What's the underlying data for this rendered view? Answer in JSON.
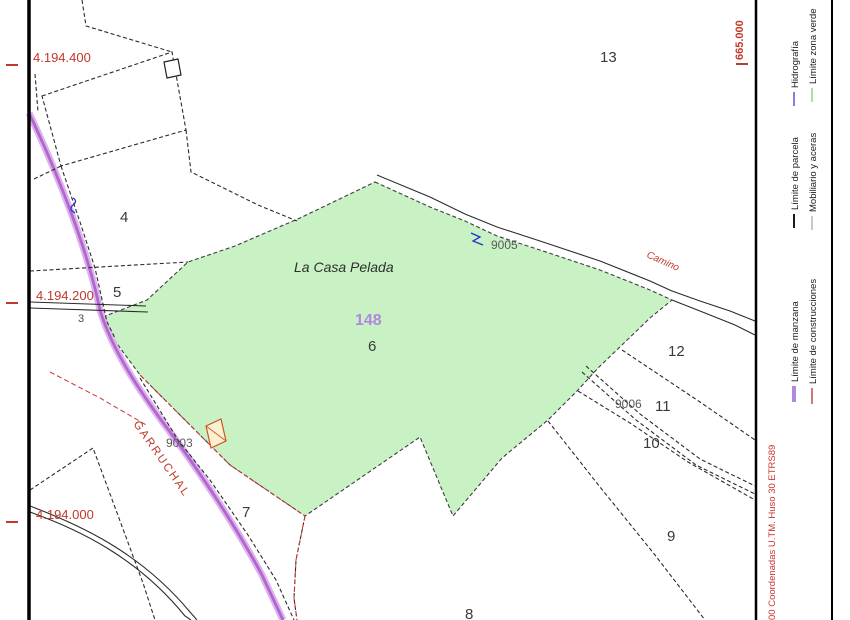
{
  "area": {
    "name": "La Casa Pelada",
    "block": "148"
  },
  "parcels": [
    "4",
    "13",
    "5",
    "3",
    "12",
    "11",
    "10",
    "9",
    "8",
    "7",
    "6"
  ],
  "codes": [
    "9005",
    "9006",
    "9003"
  ],
  "roads": {
    "garruchal": "GARRUCHAL",
    "camino": "Camino"
  },
  "coords": {
    "y1": "4.194.400",
    "y2": "4.194.200",
    "y3": "4.194.000",
    "x1": "665.000"
  },
  "colors": {
    "green_fill": "#c9f2c4",
    "green_edge": "#3d3d3d",
    "road_core": "#b066cc",
    "road_glow": "#ddb3ee",
    "block_purple": "#b287e0",
    "red": "#c0392b"
  },
  "legend": {
    "items": [
      {
        "label": "Hidrografía",
        "color": "#8c7ae6",
        "width": 2
      },
      {
        "label": "Límite zona verde",
        "color": "#9fe6a0",
        "width": 2
      },
      {
        "label": "Límite de parcela",
        "color": "#1a1a1a",
        "width": 2
      },
      {
        "label": "Mobiliario y aceras",
        "color": "#c8c8c8",
        "width": 2
      },
      {
        "label": "Límite de manzana",
        "color": "#b287e0",
        "width": 4
      },
      {
        "label": "Límite de construcciones",
        "color": "#cc4444",
        "width": 1.5
      }
    ],
    "coords_note": "00 Coordenadas U.TM. Huso 30 ETRS89"
  }
}
